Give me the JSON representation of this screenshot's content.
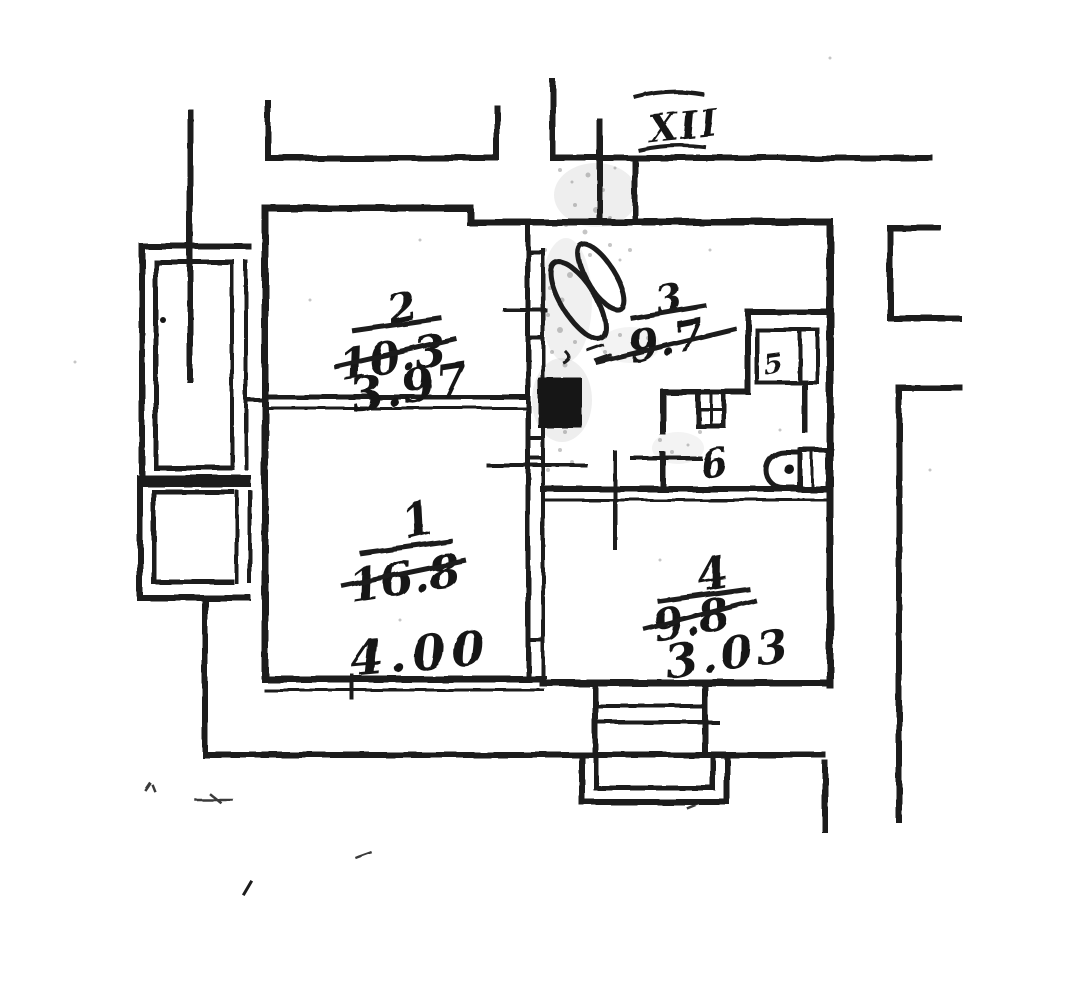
{
  "plan": {
    "stairwell_label": "XII",
    "rooms": {
      "room1": {
        "number": "1",
        "area": "16.8",
        "width": "4.00"
      },
      "room2": {
        "number": "2",
        "area": "10.3",
        "width": "3.97"
      },
      "room3": {
        "number": "3",
        "area": "9.7"
      },
      "room4": {
        "number": "4",
        "area": "9.8",
        "width": "3.03"
      },
      "room5": {
        "number": "5"
      },
      "hall": {
        "number": "6"
      }
    },
    "ink_color": "#1a1a1a",
    "paper_color": "#ffffff"
  }
}
